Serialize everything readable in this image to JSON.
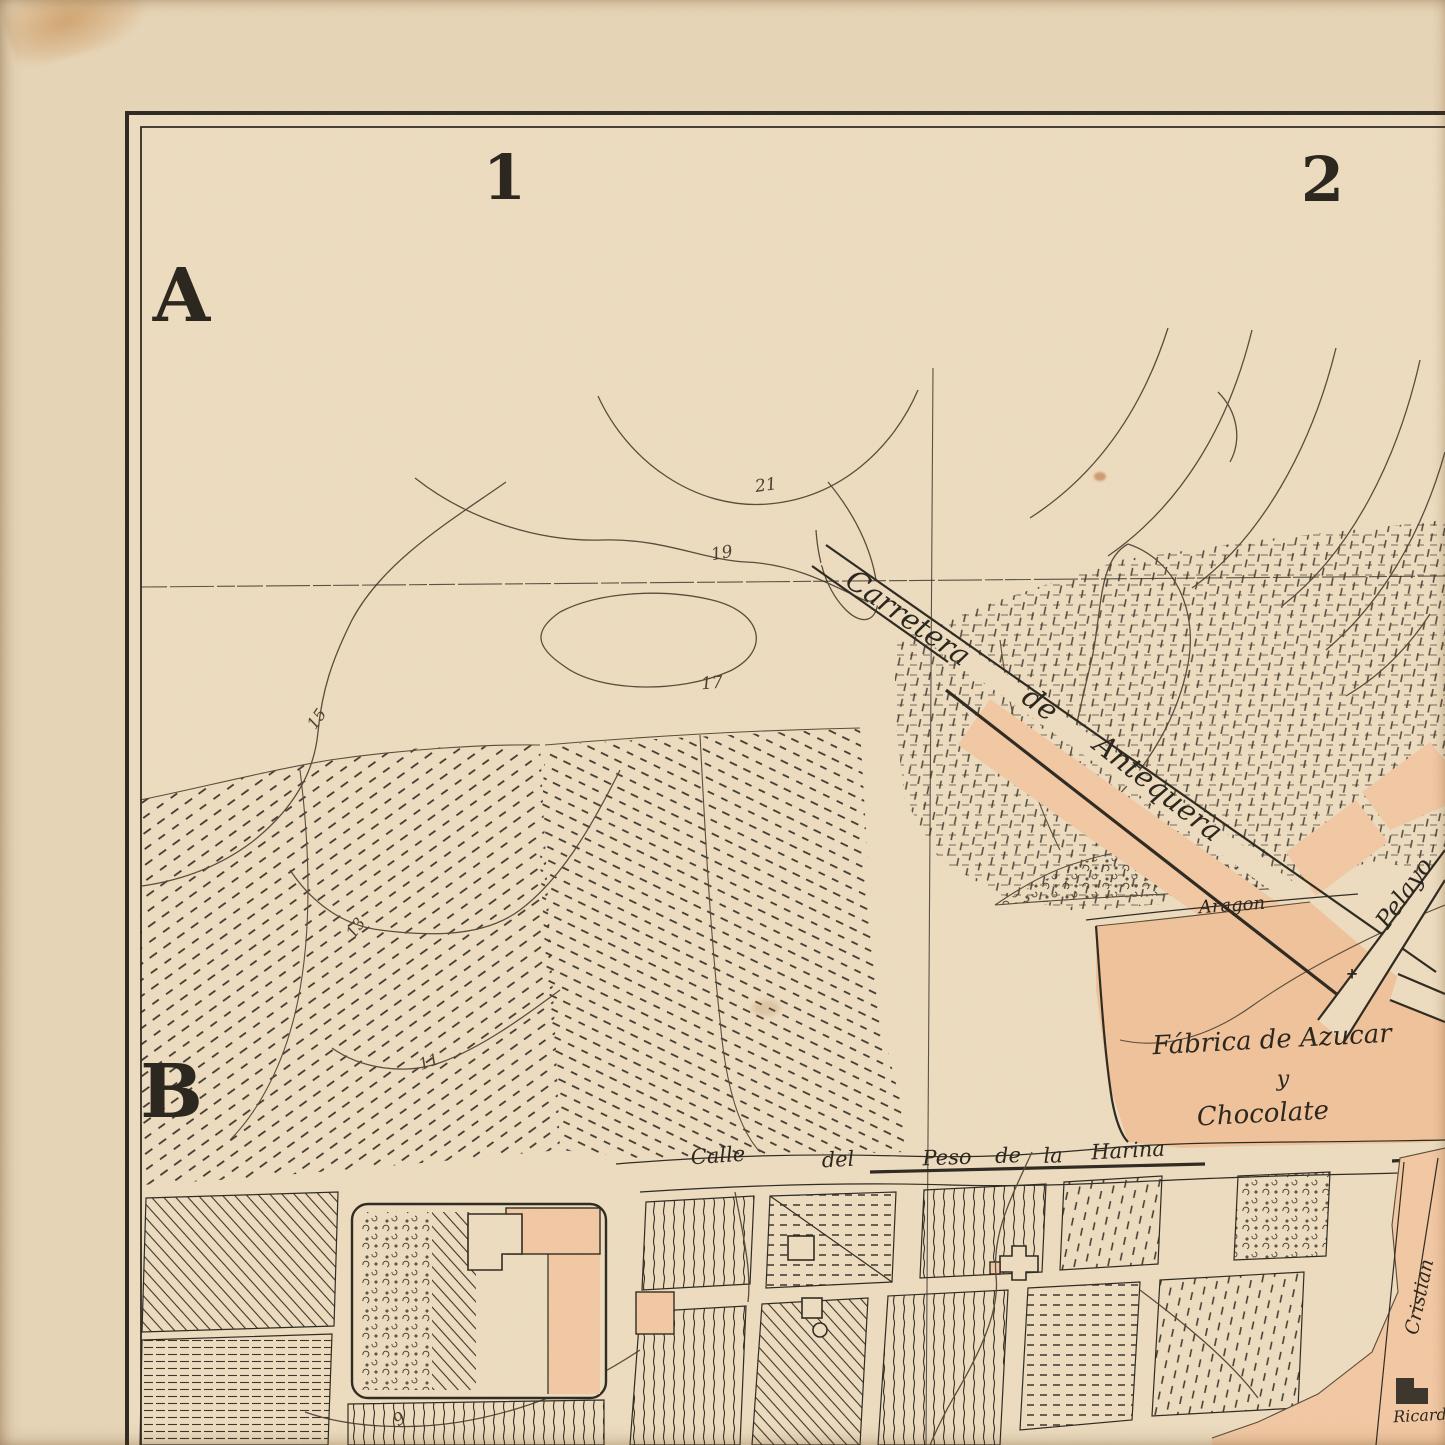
{
  "map": {
    "kind": "antique city plan sheet (cropped top-left quadrant)",
    "grid": {
      "columns": [
        "1",
        "2"
      ],
      "rows": [
        "A",
        "B"
      ]
    },
    "streets": [
      "Carretera de Antequera",
      "Aragon",
      "Pelayo",
      "Calle del Peso de la Harina",
      "Cristian",
      "Ricard"
    ],
    "areas": [
      "Fábrica de Azucar y Chocolate"
    ],
    "contour_elevations": [
      21,
      19,
      17,
      15,
      13,
      11,
      9
    ]
  },
  "colors": {
    "paper": "#e7d5b6",
    "paper-map": "#eddcbf",
    "ink": "#2d281f",
    "contour": "#584a38",
    "hatch": "#3a332a",
    "salmon": "#f2c8a2",
    "salmon-deep": "#f0c29a",
    "stain": "#c07b35"
  },
  "labels": [
    {
      "id": "col-1",
      "text": "1",
      "x": 505,
      "y": 178,
      "rot": 0,
      "size": 62,
      "cls": "grid-l"
    },
    {
      "id": "col-2",
      "text": "2",
      "x": 1323,
      "y": 180,
      "rot": 0,
      "size": 62,
      "cls": "grid-l"
    },
    {
      "id": "row-a",
      "text": "A",
      "x": 182,
      "y": 296,
      "rot": 0,
      "size": 74,
      "cls": "grid-l"
    },
    {
      "id": "row-b",
      "text": "B",
      "x": 172,
      "y": 1092,
      "rot": 0,
      "size": 74,
      "cls": "grid-l"
    },
    {
      "id": "elev-21",
      "text": "21",
      "x": 766,
      "y": 486,
      "rot": -8,
      "size": 17,
      "cls": "contour"
    },
    {
      "id": "elev-19",
      "text": "19",
      "x": 722,
      "y": 554,
      "rot": -10,
      "size": 17,
      "cls": "contour"
    },
    {
      "id": "elev-17",
      "text": "17",
      "x": 712,
      "y": 684,
      "rot": -5,
      "size": 17,
      "cls": "contour"
    },
    {
      "id": "elev-15",
      "text": "15",
      "x": 317,
      "y": 719,
      "rot": -55,
      "size": 16,
      "cls": "contour"
    },
    {
      "id": "elev-13",
      "text": "13",
      "x": 356,
      "y": 928,
      "rot": -55,
      "size": 16,
      "cls": "contour"
    },
    {
      "id": "elev-11",
      "text": "11",
      "x": 429,
      "y": 1062,
      "rot": -20,
      "size": 16,
      "cls": "contour"
    },
    {
      "id": "elev-9",
      "text": "9",
      "x": 400,
      "y": 1420,
      "rot": -35,
      "size": 17,
      "cls": "contour"
    },
    {
      "id": "carretera-1",
      "text": "Carretera",
      "x": 908,
      "y": 618,
      "rot": 35,
      "size": 29,
      "cls": "street"
    },
    {
      "id": "carretera-2",
      "text": "de",
      "x": 1040,
      "y": 704,
      "rot": 36,
      "size": 29,
      "cls": "street"
    },
    {
      "id": "carretera-3",
      "text": "Antequera",
      "x": 1158,
      "y": 788,
      "rot": 38,
      "size": 29,
      "cls": "street"
    },
    {
      "id": "aragon",
      "text": "Aragon",
      "x": 1232,
      "y": 906,
      "rot": -4,
      "size": 18,
      "cls": "street"
    },
    {
      "id": "pelayo",
      "text": "Pelayo",
      "x": 1404,
      "y": 893,
      "rot": -55,
      "size": 24,
      "cls": "street"
    },
    {
      "id": "calle-1",
      "text": "Calle",
      "x": 718,
      "y": 1156,
      "rot": -4,
      "size": 21,
      "cls": "street"
    },
    {
      "id": "calle-2",
      "text": "del",
      "x": 838,
      "y": 1160,
      "rot": -3,
      "size": 21,
      "cls": "street"
    },
    {
      "id": "calle-3",
      "text": "Peso",
      "x": 947,
      "y": 1158,
      "rot": -2,
      "size": 21,
      "cls": "street"
    },
    {
      "id": "calle-4",
      "text": "de",
      "x": 1008,
      "y": 1156,
      "rot": -2,
      "size": 21,
      "cls": "street"
    },
    {
      "id": "calle-5",
      "text": "la",
      "x": 1053,
      "y": 1156,
      "rot": -2,
      "size": 21,
      "cls": "street"
    },
    {
      "id": "calle-6",
      "text": "Harina",
      "x": 1128,
      "y": 1151,
      "rot": -3,
      "size": 21,
      "cls": "street"
    },
    {
      "id": "cristian",
      "text": "Cristian",
      "x": 1420,
      "y": 1297,
      "rot": -78,
      "size": 19,
      "cls": "street"
    },
    {
      "id": "ricardo",
      "text": "Ricard",
      "x": 1420,
      "y": 1416,
      "rot": -3,
      "size": 16,
      "cls": "street"
    },
    {
      "id": "fabrica-1",
      "text": "Fábrica de Azucar",
      "x": 1272,
      "y": 1040,
      "rot": -3,
      "size": 26,
      "cls": "area"
    },
    {
      "id": "fabrica-2",
      "text": "y",
      "x": 1283,
      "y": 1080,
      "rot": 0,
      "size": 22,
      "cls": "area"
    },
    {
      "id": "fabrica-3",
      "text": "Chocolate",
      "x": 1263,
      "y": 1114,
      "rot": -3,
      "size": 26,
      "cls": "area"
    },
    {
      "id": "cross",
      "text": "+",
      "x": 1352,
      "y": 974,
      "rot": 0,
      "size": 15,
      "cls": "symbol"
    }
  ]
}
